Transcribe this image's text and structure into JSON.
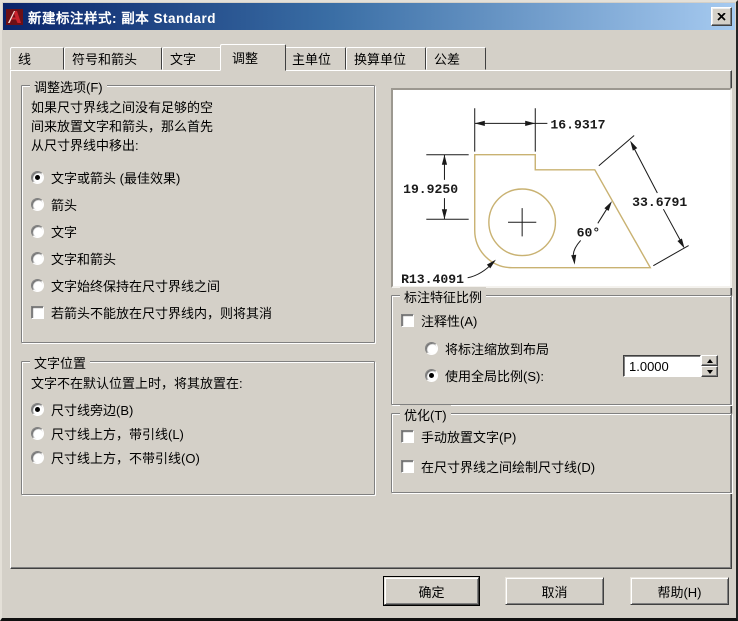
{
  "window": {
    "title": "新建标注样式: 副本 Standard"
  },
  "tabs": [
    {
      "label": "线",
      "active": false
    },
    {
      "label": "符号和箭头",
      "active": false
    },
    {
      "label": "文字",
      "active": false
    },
    {
      "label": "调整",
      "active": true
    },
    {
      "label": "主单位",
      "active": false
    },
    {
      "label": "换算单位",
      "active": false
    },
    {
      "label": "公差",
      "active": false
    }
  ],
  "fit_options": {
    "title": "调整选项(F)",
    "description_lines": [
      "如果尺寸界线之间没有足够的空",
      "间来放置文字和箭头，那么首先",
      "从尺寸界线中移出:"
    ],
    "radios": [
      {
        "label": "文字或箭头 (最佳效果)",
        "selected": true
      },
      {
        "label": "箭头",
        "selected": false
      },
      {
        "label": "文字",
        "selected": false
      },
      {
        "label": "文字和箭头",
        "selected": false
      },
      {
        "label": "文字始终保持在尺寸界线之间",
        "selected": false
      }
    ],
    "checkbox": {
      "label": "若箭头不能放在尺寸界线内，则将其消",
      "checked": false
    }
  },
  "text_placement": {
    "title": "文字位置",
    "description": "文字不在默认位置上时，将其放置在:",
    "radios": [
      {
        "label": "尺寸线旁边(B)",
        "selected": true
      },
      {
        "label": "尺寸线上方，带引线(L)",
        "selected": false
      },
      {
        "label": "尺寸线上方，不带引线(O)",
        "selected": false
      }
    ]
  },
  "preview": {
    "dim_top": "16.9317",
    "dim_left": "19.9250",
    "dim_diag": "33.6791",
    "dim_angle": "60°",
    "dim_radius": "R13.4091"
  },
  "scale_group": {
    "title": "标注特征比例",
    "annotative": {
      "label": "注释性(A)",
      "checked": false
    },
    "radios": [
      {
        "label": "将标注缩放到布局",
        "selected": false
      },
      {
        "label": "使用全局比例(S):",
        "selected": true
      }
    ],
    "scale_value": "1.0000"
  },
  "fine_tuning": {
    "title": "优化(T)",
    "checkboxes": [
      {
        "label": "手动放置文字(P)",
        "checked": false
      },
      {
        "label": "在尺寸界线之间绘制尺寸线(D)",
        "checked": false
      }
    ]
  },
  "buttons": {
    "ok": "确定",
    "cancel": "取消",
    "help": "帮助(H)"
  },
  "colors": {
    "titlebar_start": "#0a246a",
    "titlebar_end": "#a6caf0",
    "dialog_bg": "#d4d0c8",
    "shape": "#c9b272"
  }
}
